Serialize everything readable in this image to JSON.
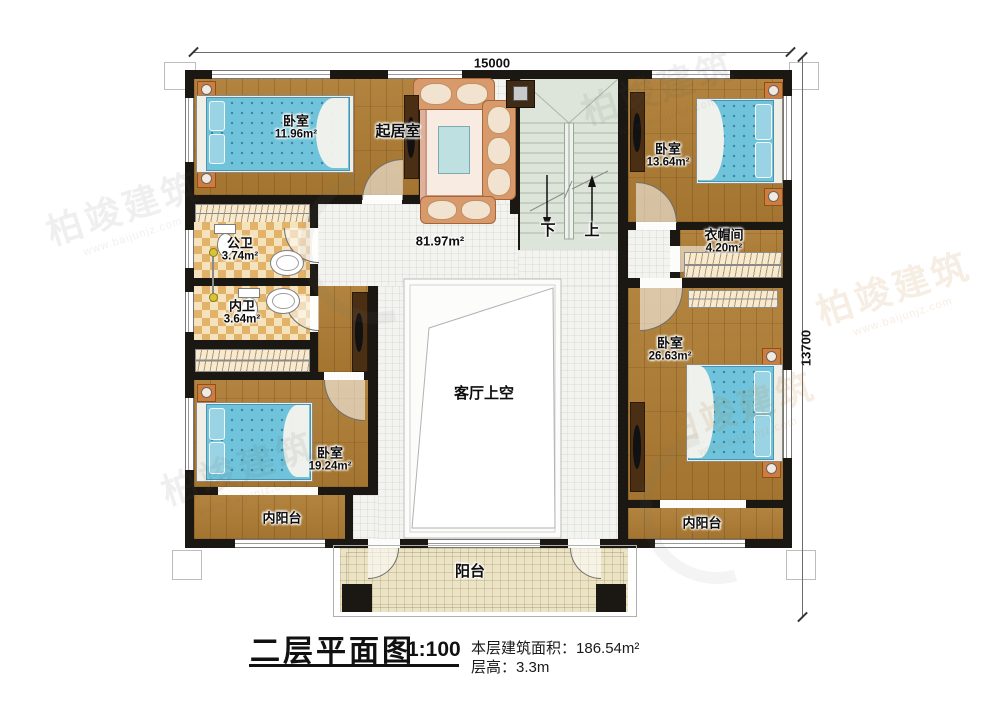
{
  "title": {
    "main": "二层平面图",
    "scale": "1:100"
  },
  "info": {
    "area_label": "本层建筑面积：",
    "area_value": "186.54m²",
    "floor_height_label": "层高：",
    "floor_height_value": "3.3m"
  },
  "dimensions": {
    "top": "15000",
    "right": "13700"
  },
  "stairs": {
    "down": "下",
    "up": "上"
  },
  "rooms": {
    "bedroom_top_left": {
      "name": "卧室",
      "area": "11.96m²"
    },
    "bedroom_top_right": {
      "name": "卧室",
      "area": "13.64m²"
    },
    "bedroom_bottom_left": {
      "name": "卧室",
      "area": "19.24m²"
    },
    "bedroom_bottom_right": {
      "name": "卧室",
      "area": "26.63m²"
    },
    "living_room": {
      "name": "起居室"
    },
    "hall": {
      "area": "81.97m²"
    },
    "public_bathroom": {
      "name": "公卫",
      "area": "3.74m²"
    },
    "inner_bathroom": {
      "name": "内卫",
      "area": "3.64m²"
    },
    "cloakroom": {
      "name": "衣帽间",
      "area": "4.20m²"
    },
    "void_over_living": {
      "name": "客厅上空"
    },
    "inner_balcony_left": {
      "name": "内阳台"
    },
    "inner_balcony_right": {
      "name": "内阳台"
    },
    "balcony": {
      "name": "阳台"
    }
  },
  "watermark": {
    "brand": "柏竣建筑",
    "site": "www.baijunjz.com"
  },
  "colors": {
    "wall": "#1b1712",
    "wood_floor": "#ad7c33",
    "hall_tile": "#f3f3f0",
    "balcony_tile": "#ebe3c6",
    "stair": "#dde4d9",
    "checker_dark": "#e2b268",
    "checker_light": "#f4e3bd",
    "mattress": "#6fc3da"
  }
}
